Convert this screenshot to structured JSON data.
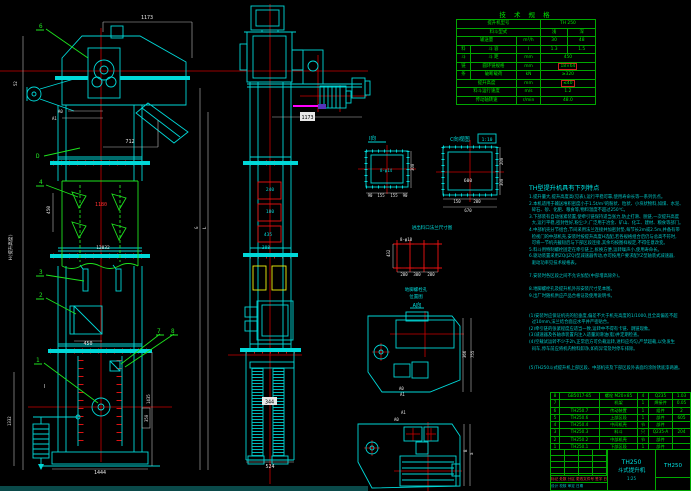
{
  "colors": {
    "background": "#000000",
    "line_cyan": "#00dcdc",
    "line_green": "#1ee31e",
    "centerline_red": "#cc0000",
    "part_red": "#ee1111",
    "dim_white": "#d9d9d9",
    "yellow": "#f2f20c",
    "magenta": "#ff00ff",
    "table_green": "#00e400"
  },
  "tech_table": {
    "title": "技 术 规 格",
    "rows": [
      {
        "c0": "提升机型号",
        "c1": "TH 250"
      },
      {
        "c0": "料斗型式",
        "c1": "浅",
        "c2": "深"
      },
      {
        "c0": "输送量",
        "c1": "m³/h",
        "c2": "30",
        "c3": "48"
      },
      {
        "g": "料",
        "c0": "斗 容",
        "c1": "l",
        "c2": "1.3",
        "c3": "1.5"
      },
      {
        "g": "斗",
        "c0": "斗 距",
        "c1": "mm",
        "c2": "450"
      },
      {
        "g": "链",
        "c0": "圆环链规格",
        "c1": "mm",
        "c2": "18×64"
      },
      {
        "g": "条",
        "c0": "破断载荷",
        "c1": "kN",
        "c2": "≥320"
      },
      {
        "c0": "提升高度",
        "c1": "mm",
        "c2": "≤40"
      },
      {
        "c0": "料斗运行速度",
        "c1": "m/s",
        "c2": "1.2"
      },
      {
        "c0": "传动轴转速",
        "c1": "r/min",
        "c2": "48.0"
      }
    ]
  },
  "notes": {
    "title": "TH型提升机具有下列特点",
    "lines": [
      "1.提升量大,提升高度高(见表),运行平稳可靠,使用寿命长等一系列优点。",
      "2.本机适用于输送堆积密度小于1.5t/m³的粉状、粒状、小块状物料,如煤、水泥、",
      "  碎石、砂、化肥、粮食等,物料温度不超过250℃。",
      "3.下部装有自动张紧装置,使牵引链保持适当张力,防止打滑、脱链,一次提升高度",
      "  大,运行平稳,密封性好,粉尘少,广泛用于冶金、矿山、化工、建材、粮食等部门。",
      "4.中部机壳分节组合,节间采用法兰连接并加密封垫,每节长2m或2.5m,并备有带",
      "  检视门的中部机壳,安装时按提升高度H选配,若各规格组合后仍与总高不符时,",
      "  可将一节机壳截短后与下部区段连接,其余均按图样规定,不得任意改变。",
      "5.料斗用特制螺栓固定在牵引链上,拆换方便,运转噪声小,使用寿命长。",
      "6.驱动装置采用ZQ(JZQ)型减速器传动,亦可按用户要求配YZ型轴装式减速器,",
      "  驱动功率见技术规格表。",
      "",
      "7.安装时各区段之间不允许加垫(中部增高除外)。",
      "",
      "8.地脚螺栓孔及提升机外形安装尺寸见本图。",
      "9.出厂时随机供应产品合格证及使用说明书。",
      "",
      "",
      "(1)安装时应保证机壳的铅垂度,偏差不大于机壳高度的1/1000,且全高偏差不超",
      "  过10mm,法兰结合面应水平并严密贴合。",
      "(2)牵引链的张紧程度应适当一致,运转中不得有卡链、跳链现象。",
      "(3)减速器及各轴承装置内注入适量润滑油(脂)并定期检查。",
      "(4)空载试运转不少于2h,正常后方可负载运转,进料应均匀,严禁超载,以免发生",
      "  闷车,停车前应将机内物料卸净,如有异常及时停车排除。",
      "",
      "",
      "(5)TH250斗式提升机上部区段、中部机壳及下部区段外表面均涂防锈底漆两遍。"
    ]
  },
  "bom": {
    "header": {
      "no": "序号",
      "code": "代  号",
      "name": "名  称",
      "qty": "数量",
      "mat": "材  料",
      "wt": "重量",
      "note": "备注"
    },
    "rows": [
      {
        "no": "8",
        "code": "GB5017-85",
        "name": "螺栓 M20×85",
        "qty": "4",
        "mat": "Q235",
        "wt": "1.03",
        "note": ""
      },
      {
        "no": "7",
        "code": "",
        "name": "机架",
        "qty": "1",
        "mat": "焊接件",
        "wt": "0.05",
        "note": ""
      },
      {
        "no": "6",
        "code": "TH250.7",
        "name": "传动装置",
        "qty": "1",
        "mat": "组件",
        "wt": "2",
        "note": ""
      },
      {
        "no": "5",
        "code": "TH250.6",
        "name": "上部区段",
        "qty": "1",
        "mat": "部件",
        "wt": "605",
        "note": ""
      },
      {
        "no": "4",
        "code": "TH250.4",
        "name": "中间机壳",
        "qty": "节",
        "mat": "部件",
        "wt": "",
        "note": ""
      },
      {
        "no": "3",
        "code": "TH250.3",
        "name": "料斗",
        "qty": "只",
        "mat": "Q235-A",
        "wt": "204",
        "note": ""
      },
      {
        "no": "2",
        "code": "TH250.2",
        "name": "中部机壳",
        "qty": "节",
        "mat": "部件",
        "wt": "",
        "note": ""
      },
      {
        "no": "1",
        "code": "TH250.1",
        "name": "下部区段",
        "qty": "1",
        "mat": "部件",
        "wt": "",
        "note": ""
      }
    ]
  },
  "title_block": {
    "product_model": "TH250",
    "product_name": "斗式提升机",
    "drawing_no": "TH250",
    "rev_row": "标记 处数 分区 更改文件号 签字 日期",
    "sign_row": "设计  校核  审定  日期",
    "scale": "1:25"
  },
  "balloons": {
    "b1": "1",
    "b2": "2",
    "b3": "3",
    "b4": "4",
    "b6": "6",
    "b7": "7",
    "b8": "8"
  },
  "dims": {
    "left": {
      "d1173": "1173",
      "d712": "712",
      "a0": "A0",
      "a1": "A1",
      "d52": "52",
      "dD": "D",
      "d1180": "1180",
      "d450v": "450",
      "d12032": "12032",
      "d450f": "450",
      "secI": "Ⅰ",
      "d1435": "1435",
      "d350": "350",
      "d1332": "1332",
      "d1444": "1444",
      "hLabel": "H(提升高度)",
      "gLabel": "G",
      "lLabel": "L"
    },
    "mid": {
      "d240": "240",
      "d180": "180",
      "d435": "435",
      "d388": "388",
      "d344": "344",
      "d524": "524",
      "d1173": "1173"
    },
    "det": {
      "viewA_label": "Ⅰ向",
      "viewA_hole": "8-φ14",
      "viewA_300": "300",
      "viewA_b1": "90",
      "viewA_b2": "155",
      "viewA_b3": "155",
      "viewA_b4": "90",
      "viewB_label": "C向视图",
      "viewB_scale": "1:10",
      "viewB_600": "600",
      "viewB_150": "150",
      "viewB_200": "200",
      "viewB_670": "670",
      "viewB_r200": "200",
      "viewB_r300": "300",
      "cap1": "进出料口法兰尺寸图",
      "grid_label": "8-φ18",
      "grid_432": "432",
      "grid_b1": "200",
      "grid_b2": "300",
      "grid_b3": "200",
      "cap2a": "地脚螺栓孔",
      "cap2b": "位置图",
      "aview": "A向",
      "p1_a0": "A0",
      "p1_a1": "A1",
      "p1_366": "366",
      "p1_755": "755",
      "p2_a1": "A1",
      "p2_a0": "A0",
      "p2_B": "B",
      "p2_a": "a"
    }
  }
}
